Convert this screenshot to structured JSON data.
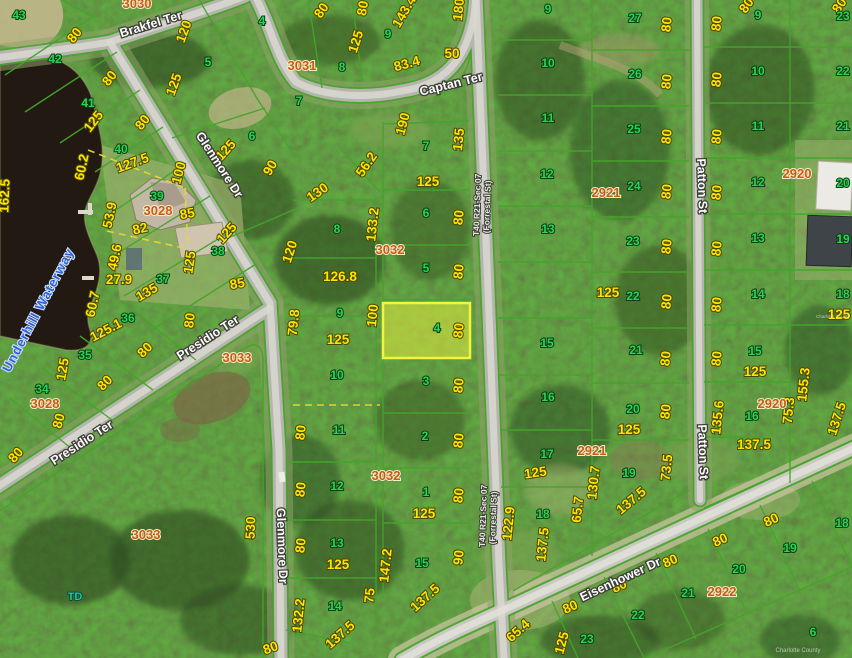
{
  "colors": {
    "parcel_line": "#46a32b",
    "dimension_text": "#ffe400",
    "lot_text": "#2bd455",
    "block_text": "#c95a14",
    "highlight_fill": "#d8e23e",
    "highlight_stroke": "#f2f53c",
    "water_fill": "#221912"
  },
  "highlighted_parcel": {
    "lot": "4",
    "block": "3032"
  },
  "map_labels": [
    [
      "80",
      78,
      38,
      -52,
      "dim"
    ],
    [
      "80",
      113,
      81,
      -52,
      "dim"
    ],
    [
      "125",
      97,
      124,
      -52,
      "dim"
    ],
    [
      "80",
      146,
      125,
      -52,
      "dim"
    ],
    [
      "120",
      188,
      33,
      -70,
      "dim"
    ],
    [
      "125",
      178,
      86,
      -70,
      "dim"
    ],
    [
      "125",
      229,
      153,
      -48,
      "dim"
    ],
    [
      "90",
      274,
      170,
      -60,
      "dim"
    ],
    [
      "80",
      325,
      13,
      -55,
      "dim"
    ],
    [
      "125",
      360,
      43,
      -72,
      "dim"
    ],
    [
      "80",
      367,
      9,
      -80,
      "dim"
    ],
    [
      "143.4",
      408,
      14,
      -60,
      "dim"
    ],
    [
      "180",
      463,
      10,
      -84,
      "dim"
    ],
    [
      "50",
      452,
      58,
      0,
      "dim"
    ],
    [
      "83.4",
      408,
      68,
      -15,
      "dim"
    ],
    [
      "190",
      407,
      125,
      -75,
      "dim"
    ],
    [
      "135",
      463,
      140,
      -84,
      "dim"
    ],
    [
      "56.2",
      370,
      167,
      -55,
      "dim"
    ],
    [
      "125",
      428,
      186,
      0,
      "dim"
    ],
    [
      "130",
      320,
      196,
      -35,
      "dim"
    ],
    [
      "133.2",
      377,
      225,
      -84,
      "dim"
    ],
    [
      "120",
      294,
      253,
      -72,
      "dim"
    ],
    [
      "80",
      463,
      218,
      -84,
      "dim"
    ],
    [
      "80",
      463,
      272,
      -84,
      "dim"
    ],
    [
      "126.8",
      340,
      281,
      0,
      "dim"
    ],
    [
      "100",
      377,
      316,
      -84,
      "dim"
    ],
    [
      "79.8",
      298,
      323,
      -84,
      "dim"
    ],
    [
      "80",
      463,
      331,
      -84,
      "dim"
    ],
    [
      "125",
      338,
      344,
      0,
      "dim"
    ],
    [
      "80",
      305,
      433,
      -84,
      "dim"
    ],
    [
      "80",
      463,
      386,
      -84,
      "dim"
    ],
    [
      "80",
      463,
      441,
      -84,
      "dim"
    ],
    [
      "80",
      305,
      490,
      -84,
      "dim"
    ],
    [
      "80",
      463,
      496,
      -84,
      "dim"
    ],
    [
      "80",
      305,
      546,
      -84,
      "dim"
    ],
    [
      "125",
      338,
      569,
      0,
      "dim"
    ],
    [
      "147.2",
      390,
      566,
      -84,
      "dim"
    ],
    [
      "90",
      463,
      558,
      -84,
      "dim"
    ],
    [
      "125",
      424,
      518,
      0,
      "dim"
    ],
    [
      "75",
      374,
      596,
      -84,
      "dim"
    ],
    [
      "137.5",
      428,
      601,
      -42,
      "dim"
    ],
    [
      "132.2",
      303,
      616,
      -84,
      "dim"
    ],
    [
      "137.5",
      343,
      638,
      -42,
      "dim"
    ],
    [
      "122.9",
      513,
      524,
      -84,
      "dim"
    ],
    [
      "65.4",
      521,
      634,
      -42,
      "dim"
    ],
    [
      "60.2",
      86,
      168,
      -78,
      "dim"
    ],
    [
      "127.5",
      134,
      167,
      -20,
      "dim"
    ],
    [
      "100",
      183,
      174,
      -75,
      "dim"
    ],
    [
      "53.9",
      114,
      216,
      -78,
      "dim"
    ],
    [
      "82",
      141,
      233,
      -12,
      "dim"
    ],
    [
      "85",
      188,
      218,
      -10,
      "dim"
    ],
    [
      "49.6",
      119,
      258,
      -78,
      "dim"
    ],
    [
      "27.9",
      119,
      284,
      0,
      "dim"
    ],
    [
      "135",
      149,
      296,
      -30,
      "dim"
    ],
    [
      "85",
      238,
      288,
      -10,
      "dim"
    ],
    [
      "60.7",
      97,
      305,
      -78,
      "dim"
    ],
    [
      "162.5",
      9,
      196,
      -88,
      "dim"
    ],
    [
      "125",
      230,
      236,
      -48,
      "dim"
    ],
    [
      "125",
      194,
      263,
      -82,
      "dim"
    ],
    [
      "80",
      194,
      321,
      -82,
      "dim"
    ],
    [
      "125.1",
      108,
      334,
      -28,
      "dim"
    ],
    [
      "125",
      67,
      370,
      -80,
      "dim"
    ],
    [
      "80",
      148,
      353,
      -45,
      "dim"
    ],
    [
      "80",
      108,
      386,
      -45,
      "dim"
    ],
    [
      "80",
      63,
      422,
      -75,
      "dim"
    ],
    [
      "80",
      19,
      458,
      -48,
      "dim"
    ],
    [
      "530",
      255,
      528,
      -88,
      "dim"
    ],
    [
      "80",
      272,
      652,
      -20,
      "dim"
    ],
    [
      "137.5",
      547,
      545,
      -84,
      "dim"
    ],
    [
      "125",
      566,
      644,
      -75,
      "dim"
    ],
    [
      "80",
      572,
      611,
      -25,
      "dim"
    ],
    [
      "80",
      621,
      590,
      -25,
      "dim"
    ],
    [
      "80",
      672,
      565,
      -25,
      "dim"
    ],
    [
      "80",
      722,
      544,
      -25,
      "dim"
    ],
    [
      "80",
      773,
      524,
      -25,
      "dim"
    ],
    [
      "80",
      671,
      25,
      -84,
      "dim"
    ],
    [
      "80",
      671,
      82,
      -84,
      "dim"
    ],
    [
      "80",
      671,
      137,
      -84,
      "dim"
    ],
    [
      "80",
      671,
      192,
      -84,
      "dim"
    ],
    [
      "80",
      671,
      247,
      -84,
      "dim"
    ],
    [
      "80",
      671,
      302,
      -84,
      "dim"
    ],
    [
      "80",
      670,
      359,
      -84,
      "dim"
    ],
    [
      "80",
      670,
      412,
      -84,
      "dim"
    ],
    [
      "125",
      629,
      434,
      0,
      "dim"
    ],
    [
      "73.5",
      671,
      468,
      -84,
      "dim"
    ],
    [
      "137.5",
      634,
      504,
      -40,
      "dim"
    ],
    [
      "130.7",
      598,
      483,
      -84,
      "dim"
    ],
    [
      "65.7",
      582,
      510,
      -84,
      "dim"
    ],
    [
      "125",
      536,
      477,
      -8,
      "dim"
    ],
    [
      "125",
      608,
      297,
      0,
      "dim"
    ],
    [
      "80",
      721,
      24,
      -84,
      "dim"
    ],
    [
      "80",
      721,
      80,
      -84,
      "dim"
    ],
    [
      "80",
      721,
      137,
      -84,
      "dim"
    ],
    [
      "80",
      721,
      193,
      -84,
      "dim"
    ],
    [
      "80",
      721,
      249,
      -84,
      "dim"
    ],
    [
      "80",
      721,
      305,
      -84,
      "dim"
    ],
    [
      "80",
      721,
      359,
      -84,
      "dim"
    ],
    [
      "125",
      755,
      376,
      0,
      "dim"
    ],
    [
      "135.6",
      722,
      418,
      -84,
      "dim"
    ],
    [
      "75.3",
      793,
      411,
      -84,
      "dim"
    ],
    [
      "155.3",
      808,
      385,
      -84,
      "dim"
    ],
    [
      "137.5",
      754,
      449,
      0,
      "dim"
    ],
    [
      "137.5",
      841,
      420,
      -72,
      "dim"
    ],
    [
      "125",
      839,
      319,
      0,
      "dim"
    ],
    [
      "80",
      750,
      8,
      -55,
      "dim"
    ],
    [
      "80",
      843,
      8,
      -55,
      "dim"
    ],
    [
      "43",
      19,
      19,
      0,
      "lot"
    ],
    [
      "42",
      55,
      63,
      0,
      "lot"
    ],
    [
      "41",
      88,
      107,
      0,
      "lot"
    ],
    [
      "40",
      121,
      153,
      0,
      "lot"
    ],
    [
      "39",
      157,
      200,
      0,
      "lot"
    ],
    [
      "38",
      218,
      255,
      0,
      "lot"
    ],
    [
      "37",
      163,
      283,
      0,
      "lot"
    ],
    [
      "36",
      128,
      322,
      0,
      "lot"
    ],
    [
      "35",
      85,
      359,
      0,
      "lot"
    ],
    [
      "34",
      42,
      393,
      0,
      "lot"
    ],
    [
      "4",
      262,
      25,
      0,
      "lot"
    ],
    [
      "5",
      208,
      66,
      0,
      "lot"
    ],
    [
      "6",
      252,
      140,
      0,
      "lot"
    ],
    [
      "7",
      299,
      105,
      0,
      "lot"
    ],
    [
      "8",
      342,
      71,
      0,
      "lot"
    ],
    [
      "9",
      388,
      38,
      0,
      "lot"
    ],
    [
      "7",
      426,
      150,
      0,
      "lot"
    ],
    [
      "6",
      426,
      217,
      0,
      "lot"
    ],
    [
      "5",
      426,
      272,
      0,
      "lot"
    ],
    [
      "4",
      437,
      332,
      0,
      "lot"
    ],
    [
      "3",
      426,
      385,
      0,
      "lot"
    ],
    [
      "2",
      425,
      440,
      0,
      "lot"
    ],
    [
      "1",
      426,
      496,
      0,
      "lot"
    ],
    [
      "15",
      422,
      567,
      0,
      "lot"
    ],
    [
      "8",
      337,
      233,
      0,
      "lot"
    ],
    [
      "9",
      340,
      317,
      0,
      "lot"
    ],
    [
      "10",
      337,
      379,
      0,
      "lot"
    ],
    [
      "11",
      339,
      434,
      0,
      "lot"
    ],
    [
      "12",
      337,
      490,
      0,
      "lot"
    ],
    [
      "13",
      337,
      547,
      0,
      "lot"
    ],
    [
      "14",
      335,
      610,
      0,
      "lot"
    ],
    [
      "9",
      548,
      13,
      0,
      "lot"
    ],
    [
      "10",
      548,
      67,
      0,
      "lot"
    ],
    [
      "11",
      548,
      122,
      0,
      "lot"
    ],
    [
      "12",
      547,
      178,
      0,
      "lot"
    ],
    [
      "13",
      548,
      233,
      0,
      "lot"
    ],
    [
      "15",
      547,
      347,
      0,
      "lot"
    ],
    [
      "16",
      548,
      401,
      0,
      "lot"
    ],
    [
      "17",
      547,
      458,
      0,
      "lot"
    ],
    [
      "18",
      543,
      518,
      0,
      "lot"
    ],
    [
      "27",
      635,
      22,
      0,
      "lot"
    ],
    [
      "26",
      635,
      78,
      0,
      "lot"
    ],
    [
      "25",
      634,
      133,
      0,
      "lot"
    ],
    [
      "24",
      634,
      190,
      0,
      "lot"
    ],
    [
      "23",
      633,
      245,
      0,
      "lot"
    ],
    [
      "22",
      633,
      300,
      0,
      "lot"
    ],
    [
      "21",
      636,
      354,
      0,
      "lot"
    ],
    [
      "20",
      633,
      413,
      0,
      "lot"
    ],
    [
      "19",
      629,
      477,
      0,
      "lot"
    ],
    [
      "9",
      758,
      19,
      0,
      "lot"
    ],
    [
      "10",
      758,
      75,
      0,
      "lot"
    ],
    [
      "11",
      758,
      130,
      0,
      "lot"
    ],
    [
      "12",
      758,
      186,
      0,
      "lot"
    ],
    [
      "13",
      758,
      242,
      0,
      "lot"
    ],
    [
      "14",
      758,
      298,
      0,
      "lot"
    ],
    [
      "15",
      755,
      355,
      0,
      "lot"
    ],
    [
      "16",
      752,
      420,
      0,
      "lot"
    ],
    [
      "23",
      843,
      20,
      0,
      "lot"
    ],
    [
      "22",
      843,
      75,
      0,
      "lot"
    ],
    [
      "21",
      843,
      130,
      0,
      "lot"
    ],
    [
      "20",
      843,
      187,
      0,
      "lot"
    ],
    [
      "19",
      843,
      243,
      0,
      "lot"
    ],
    [
      "18",
      843,
      298,
      0,
      "lot"
    ],
    [
      "18",
      842,
      527,
      0,
      "lot"
    ],
    [
      "19",
      790,
      552,
      0,
      "lot"
    ],
    [
      "20",
      739,
      573,
      0,
      "lot"
    ],
    [
      "21",
      688,
      597,
      0,
      "lot"
    ],
    [
      "22",
      638,
      619,
      0,
      "lot"
    ],
    [
      "23",
      587,
      643,
      0,
      "lot"
    ],
    [
      "6",
      813,
      636,
      0,
      "lot"
    ],
    [
      "3030",
      137,
      8,
      0,
      "blk"
    ],
    [
      "3031",
      302,
      70,
      0,
      "blk"
    ],
    [
      "3028",
      158,
      215,
      0,
      "blk"
    ],
    [
      "3028",
      45,
      408,
      0,
      "blk"
    ],
    [
      "3032",
      390,
      254,
      0,
      "blk"
    ],
    [
      "3032",
      386,
      480,
      0,
      "blk"
    ],
    [
      "3033",
      237,
      362,
      0,
      "blk"
    ],
    [
      "3033",
      146,
      539,
      0,
      "blk"
    ],
    [
      "2921",
      606,
      197,
      0,
      "blk"
    ],
    [
      "2921",
      592,
      455,
      0,
      "blk"
    ],
    [
      "2920",
      797,
      178,
      0,
      "blk"
    ],
    [
      "2920",
      772,
      408,
      0,
      "blk"
    ],
    [
      "2922",
      722,
      596,
      0,
      "blk"
    ],
    [
      "Brakfel Ter",
      152,
      28,
      -17,
      "st"
    ],
    [
      "Captan Ter",
      452,
      88,
      -14,
      "st"
    ],
    [
      "Glenmore Dr",
      216,
      167,
      57,
      "st"
    ],
    [
      "Glenmore Dr",
      278,
      546,
      88,
      "st"
    ],
    [
      "Presidio Ter",
      210,
      341,
      -33,
      "st"
    ],
    [
      "Presidio Ter",
      84,
      446,
      -33,
      "st"
    ],
    [
      "Eisenhower Dr",
      622,
      583,
      -25,
      "st"
    ],
    [
      "Patton St",
      698,
      186,
      88,
      "st"
    ],
    [
      "Patton St",
      699,
      452,
      88,
      "st"
    ],
    [
      "T40 R21-Sec 07",
      480,
      205,
      -88,
      "strd"
    ],
    [
      "(Forrestal St)",
      490,
      207,
      -88,
      "strd"
    ],
    [
      "T40 R21-Sec 07",
      486,
      516,
      -88,
      "strd"
    ],
    [
      "(Forrestal St)",
      496,
      518,
      -88,
      "strd"
    ],
    [
      "Underhill Waterway",
      42,
      312,
      -62,
      "water"
    ],
    [
      "TD",
      75,
      600,
      0,
      "td"
    ],
    [
      "Charlotte County",
      833,
      318,
      0,
      "wm-sm"
    ],
    [
      "Charlotte County",
      798,
      652,
      0,
      "wm"
    ]
  ]
}
